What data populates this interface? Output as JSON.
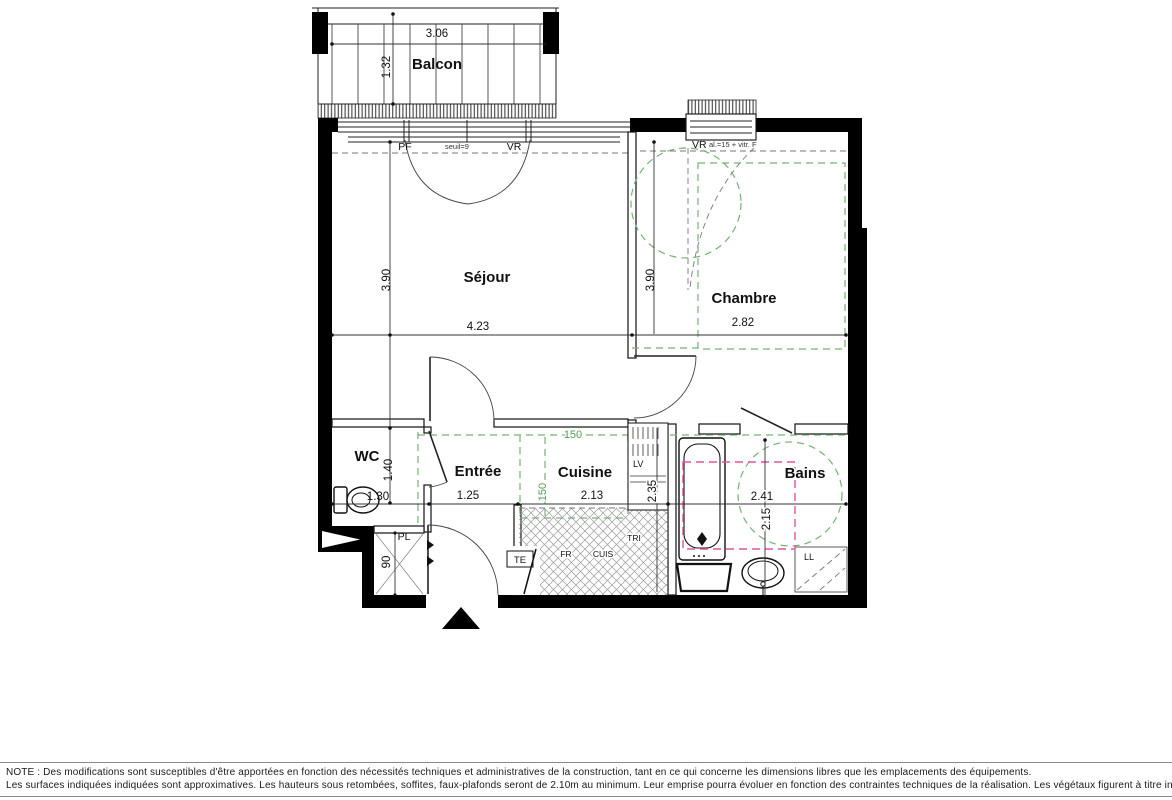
{
  "plan": {
    "rooms": {
      "balcon": {
        "label": "Balcon",
        "width": "3.06",
        "depth": "1.32"
      },
      "sejour": {
        "label": "Séjour",
        "width": "4.23",
        "depth": "3.90"
      },
      "chambre": {
        "label": "Chambre",
        "width": "2.82",
        "depth": "3.90"
      },
      "wc": {
        "label": "WC",
        "width": "1.30",
        "depth": "1.40"
      },
      "entree": {
        "label": "Entrée",
        "width": "1.25"
      },
      "cuisine": {
        "label": "Cuisine",
        "width": "2.13",
        "depth": "2.35"
      },
      "bains": {
        "label": "Bains",
        "width": "2.41",
        "depth": "2.15"
      }
    },
    "placard": {
      "label": "PL",
      "depth": "90"
    },
    "annotations": {
      "pf": "PF",
      "seuil": "seuil=9",
      "vr_sejour": "VR",
      "vr_chambre": "VR",
      "vr_chambre_info": "al.=15 + vitr. F",
      "te": "TE",
      "lv": "LV",
      "tri": "TRI",
      "fr": "FR",
      "cuis": "CUIS",
      "ll": "LL",
      "clearance_w": "150",
      "clearance_h": "150"
    },
    "colors": {
      "wall": "#000000",
      "clearance_green": "#74b274",
      "equipment_pink": "#e0559e"
    }
  },
  "note": {
    "line1": "NOTE  :  Des modifications sont susceptibles d'être apportées en fonction des nécessités techniques et administratives de la construction, tant en ce qui concerne les dimensions libres que les emplacements des équipements.",
    "line2": "Les surfaces indiquées indiquées sont approximatives. Les hauteurs sous retombées, soffites, faux-plafonds seront de 2.10m au minimum. Leur emprise pourra évoluer en fonction des contraintes techniques de la réalisation. Les végétaux figurent à titre indicatif."
  }
}
